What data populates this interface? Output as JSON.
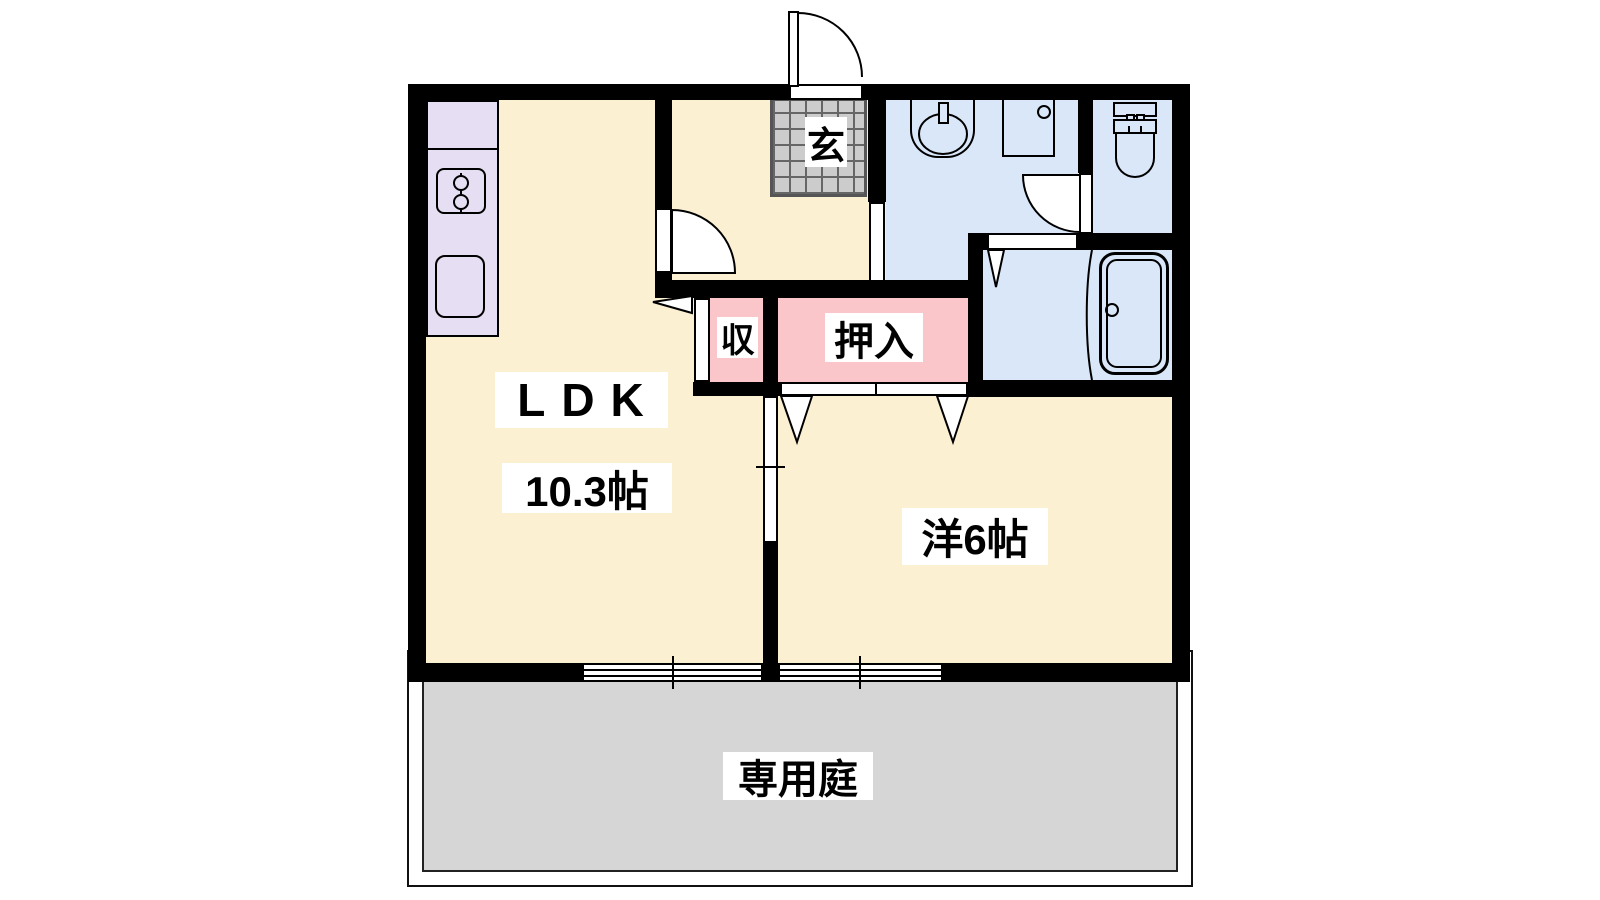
{
  "plan": {
    "type": "apartment-floor-plan",
    "rooms": {
      "ldk": {
        "label": "LDK",
        "size": "10.3帖"
      },
      "western_room": {
        "label": "洋6帖"
      },
      "closet_small": {
        "label": "収"
      },
      "closet_oshiire": {
        "label": "押入"
      },
      "entrance": {
        "label": "玄"
      },
      "garden": {
        "label": "専用庭"
      }
    },
    "fixtures": [
      "stove-icon",
      "kitchen-sink-icon",
      "washstand-icon",
      "washing-machine-icon",
      "toilet-icon",
      "bathtub-icon",
      "entrance-tile-icon",
      "swing-door-icon",
      "sliding-door-icon",
      "folding-door-icon",
      "window-icon"
    ],
    "colors": {
      "room_cream": "#FCF0D2",
      "kitchen_lavender": "#E6DEF2",
      "wet_area_blue": "#D9E7F8",
      "closet_pink": "#FBC6CA",
      "entrance_tile": "#CCCCCC",
      "garden_gray": "#D6D6D6",
      "wall": "#000000",
      "background": "#FFFFFF"
    }
  }
}
